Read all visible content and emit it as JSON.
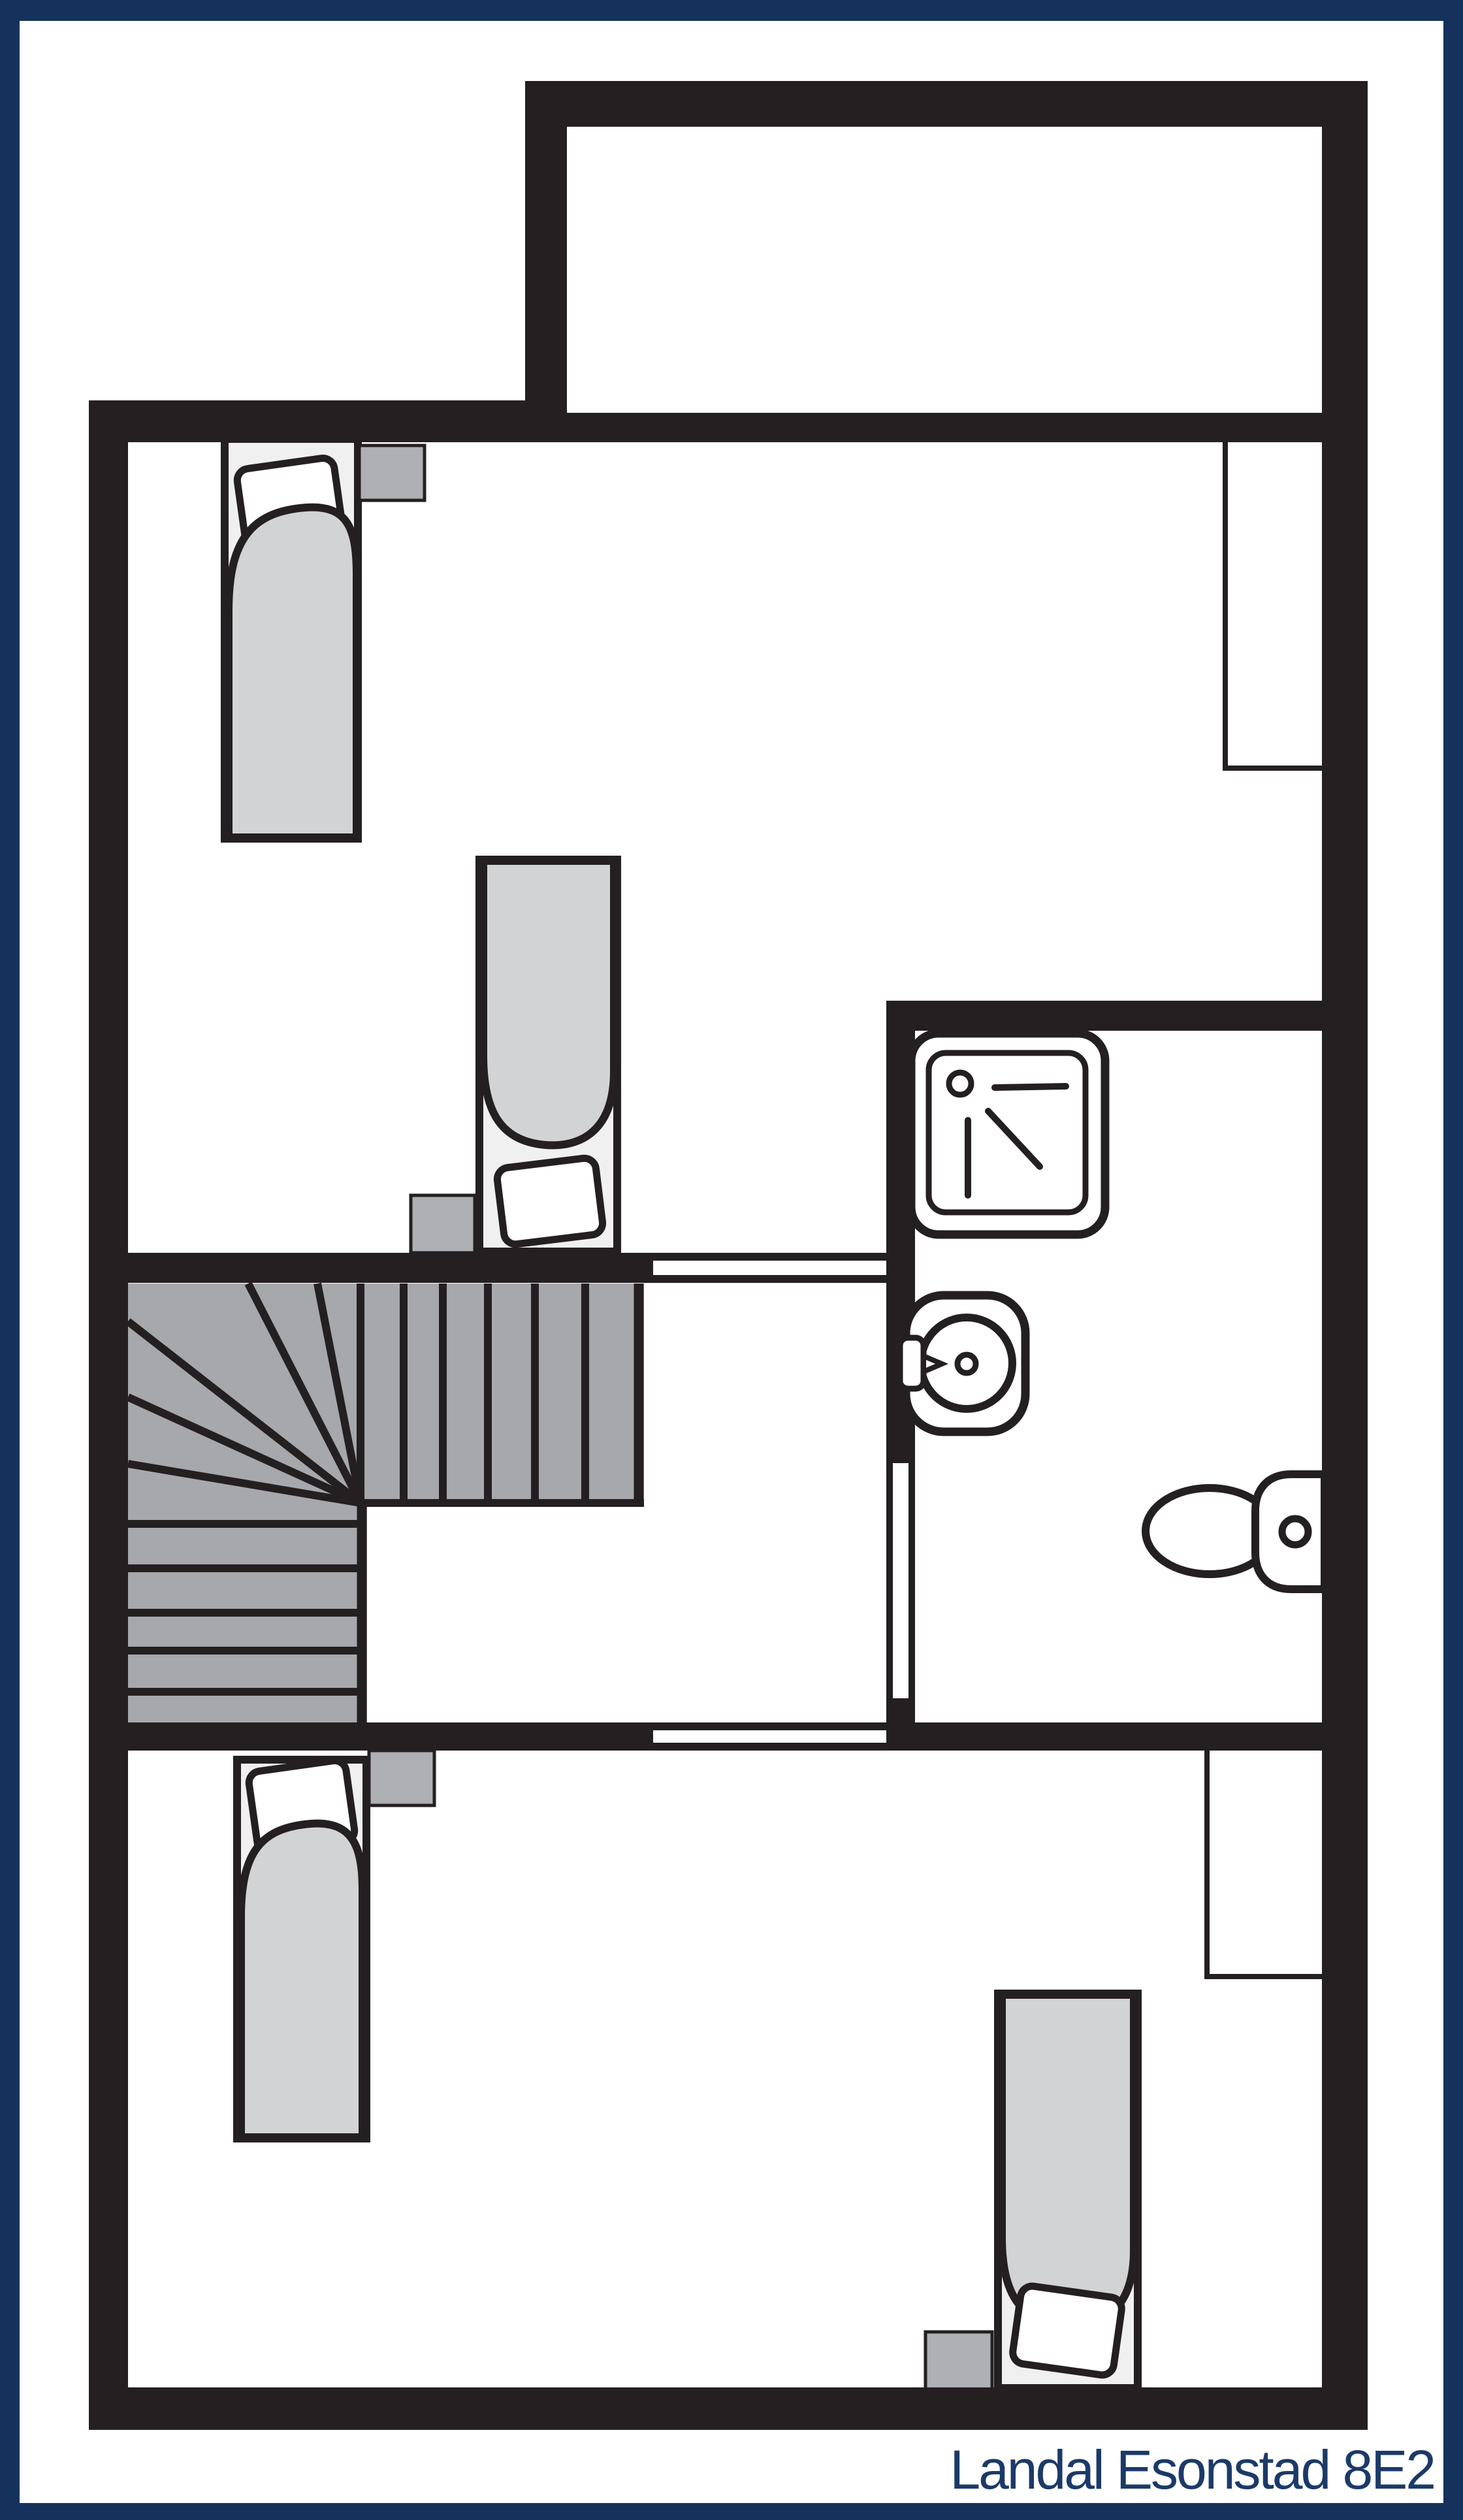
{
  "caption": {
    "text": "Landal Esonstad 8E2"
  },
  "colors": {
    "border_navy": "#14325c",
    "caption_navy": "#1b3a68",
    "wall_black": "#241f21",
    "stair_gray": "#a6a8ab",
    "furniture_gray": "#aeb0b3",
    "bedding_gray": "#d2d3d5",
    "bed_base_gray": "#f0f0f0",
    "floor_white": "#ffffff"
  },
  "plan": {
    "type": "floor-plan",
    "rooms": [
      {
        "name": "bedroom-upper",
        "furniture": [
          "single-bed",
          "single-bed",
          "nightstand",
          "nightstand"
        ]
      },
      {
        "name": "bathroom",
        "fixtures": [
          "shower",
          "washbasin",
          "toilet"
        ]
      },
      {
        "name": "landing",
        "features": [
          "winder-staircase"
        ]
      },
      {
        "name": "bedroom-lower",
        "furniture": [
          "single-bed",
          "single-bed",
          "nightstand",
          "nightstand"
        ]
      },
      {
        "name": "annex-room-top",
        "furniture": []
      }
    ],
    "window_recess_count": 2,
    "door_opening_count": 3
  }
}
